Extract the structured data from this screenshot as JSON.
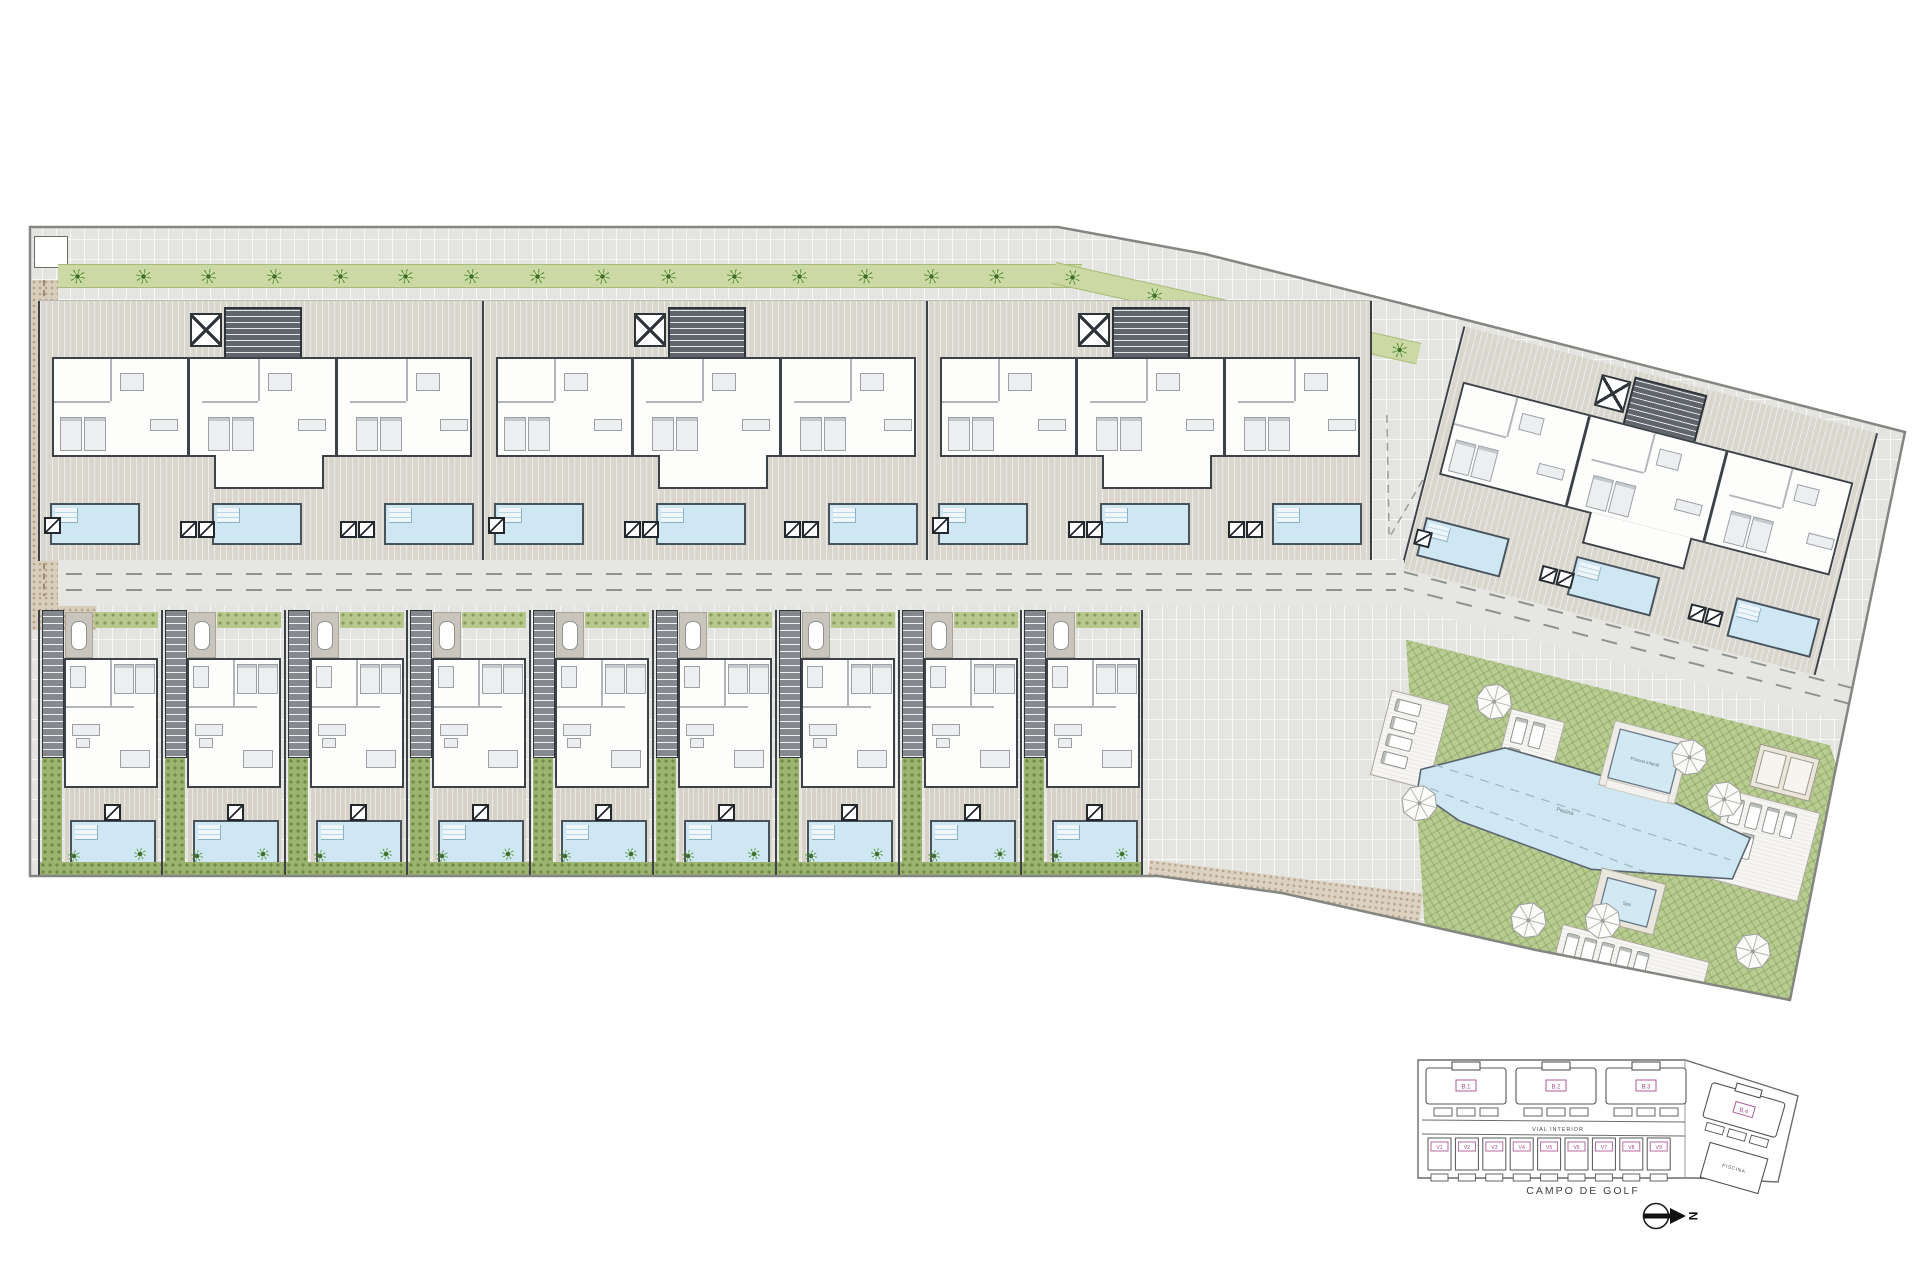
{
  "plan": {
    "keyplan": {
      "blocks": [
        {
          "id": "B.1"
        },
        {
          "id": "B.2"
        },
        {
          "id": "B.3"
        },
        {
          "id": "B.4"
        }
      ],
      "villas": [
        {
          "id": "V1"
        },
        {
          "id": "V2"
        },
        {
          "id": "V3"
        },
        {
          "id": "V4"
        },
        {
          "id": "V5"
        },
        {
          "id": "V6"
        },
        {
          "id": "V7"
        },
        {
          "id": "V8"
        },
        {
          "id": "V9"
        }
      ],
      "road_label": "VIAL INTERIOR",
      "golf_label": "CAMPO DE GOLF",
      "piscina_label": "PISCINA",
      "north_label": "N"
    },
    "communal": {
      "main_pool_label": "Piscina",
      "kids_pool_label": "Piscina infantil",
      "spa_label": "Spa"
    },
    "counts": {
      "apartment_blocks": 4,
      "villas": 9,
      "pools_per_apartment_block": 3,
      "villa_pools": 9,
      "communal_umbrellas": 7
    },
    "colors": {
      "pool_fill": "#cfe7f2",
      "pool_edge": "#47525b",
      "lawn": "#b9cc92",
      "hedge": "#cdd9a4",
      "wall": "#3d4248",
      "paving": "#e4e5e1",
      "gravel": "#d9cdbb",
      "label_pink": "#a14b8f"
    }
  }
}
